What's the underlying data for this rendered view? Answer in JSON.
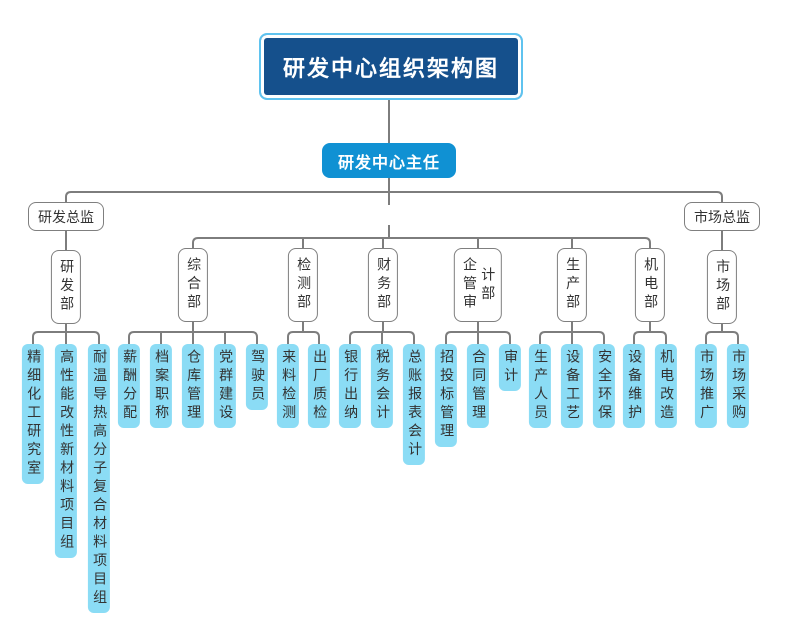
{
  "colors": {
    "title_bg": "#15508C",
    "title_outline": "#5FC3EF",
    "root_bg": "#1091D3",
    "leaf_bg": "#8BDCF5",
    "line": "#7D7D7D",
    "box_border": "#7F7F7F"
  },
  "chart": {
    "title": "研发中心组织架构图",
    "root": "研发中心主任",
    "directors": [
      {
        "label": "研发总监"
      },
      {
        "label": "市场总监"
      }
    ],
    "departments": [
      {
        "label": "研发部",
        "children": [
          "精细化工研究室",
          "高性能改性新材料项目组",
          "耐温导热高分子复合材料项目组"
        ]
      },
      {
        "label": "综合部",
        "children": [
          "薪酬分配",
          "档案职称",
          "仓库管理",
          "党群建设",
          "驾驶员"
        ]
      },
      {
        "label": "检测部",
        "children": [
          "来料检测",
          "出厂质检"
        ]
      },
      {
        "label": "财务部",
        "children": [
          "银行出纳",
          "税务会计",
          "总账报表会计"
        ]
      },
      {
        "label": "企管审计部",
        "children": [
          "招投标管理",
          "合同管理",
          "审计"
        ]
      },
      {
        "label": "生产部",
        "children": [
          "生产人员",
          "设备工艺",
          "安全环保"
        ]
      },
      {
        "label": "机电部",
        "children": [
          "设备维护",
          "机电改造"
        ]
      },
      {
        "label": "市场部",
        "children": [
          "市场推广",
          "市场采购"
        ]
      }
    ]
  }
}
